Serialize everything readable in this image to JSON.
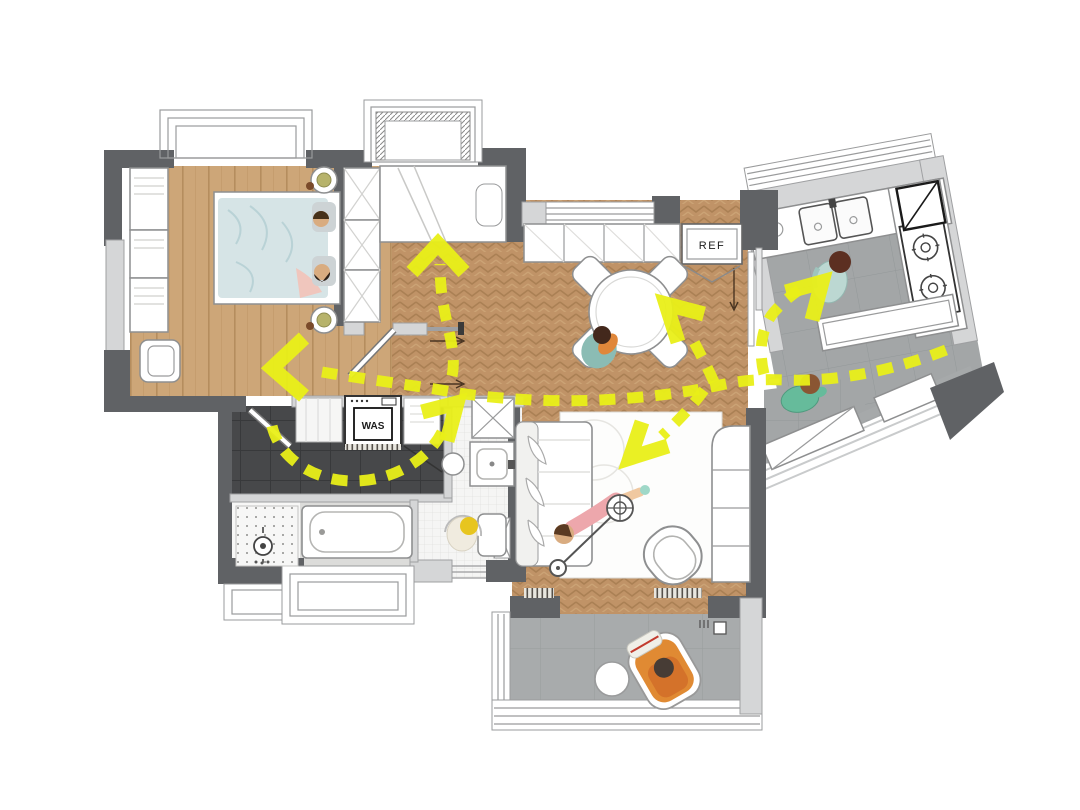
{
  "plan": {
    "labels": {
      "refrigerator": "REF",
      "washing_machine": "WAS"
    },
    "colors": {
      "circulation_yellow": "#e9ef18",
      "wood_floor": "#cda678",
      "herringbone_floor": "#c09367",
      "kitchen_tile": "#a3a6a7",
      "balcony_tile": "#a8abac",
      "bathroom_tile": "#47484a",
      "wall_dark": "#606265",
      "wall_light": "#d5d6d7"
    },
    "circulation": {
      "paths": [
        {
          "name": "main-hall-route",
          "d": "M946,350 C900,368 842,382 788,380 C758,379 742,380 716,386 C678,394 640,398 600,400 C560,402 500,400 452,392 C420,386 370,380 322,372"
        },
        {
          "name": "to-kids-bedroom",
          "d": "M452,376 C456,358 450,336 446,318 C442,300 440,284 440,264"
        },
        {
          "name": "bathroom-loop",
          "d": "M272,426 C280,460 316,482 356,481 C396,480 430,458 443,430"
        },
        {
          "name": "to-dining-table",
          "d": "M714,382 C706,364 698,350 690,334"
        },
        {
          "name": "to-kitchen-sink",
          "d": "M764,374 C758,350 762,326 774,312 C782,303 790,296 799,290"
        },
        {
          "name": "to-living-room",
          "d": "M704,390 C694,404 678,421 662,436"
        }
      ],
      "arrowheads": [
        {
          "name": "into-master-bedroom",
          "points": "304,338 272,368 304,396"
        },
        {
          "name": "into-kids-bedroom",
          "points": "412,272 438,244 464,272"
        },
        {
          "name": "into-bath-vanity",
          "points": "422,412 457,403 447,441"
        },
        {
          "name": "into-dining",
          "points": "704,314 666,304 678,342"
        },
        {
          "name": "into-kitchen",
          "points": "786,292 822,282 812,320"
        },
        {
          "name": "into-living",
          "points": "642,422 630,458 668,446"
        }
      ]
    }
  }
}
